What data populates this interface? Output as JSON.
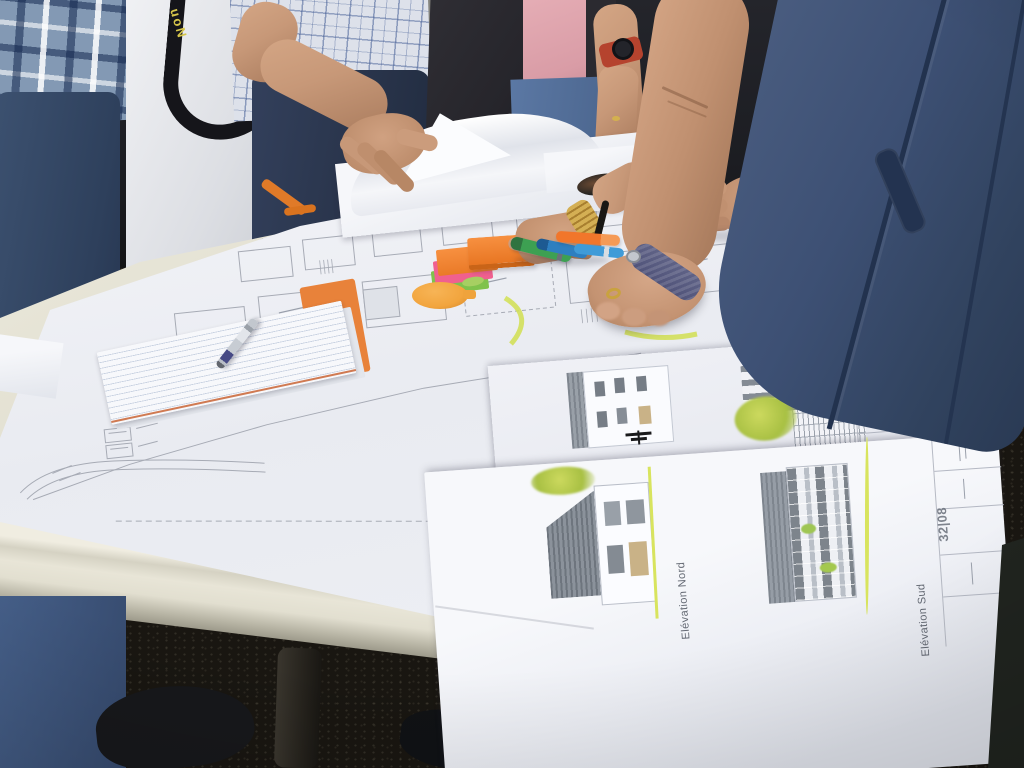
{
  "scene": {
    "setting": "Outdoor meeting: group of people standing around a white folding table reviewing large architectural plans",
    "ground": "dark gravel"
  },
  "people": [
    {
      "id": "person-plaid-shirt",
      "visible": "blue plaid shirt, dark jeans"
    },
    {
      "id": "person-white-shirt",
      "visible": "white t-shirt, black camera strap, belt, blue jeans"
    },
    {
      "id": "person-checked-shirt",
      "visible": "blue checked shirt, bare arm lifting a plan sheet"
    },
    {
      "id": "person-pink-shirt",
      "visible": "pink t-shirt, dark open jacket, jeans, wristwatch with red band"
    },
    {
      "id": "person-denim-leaning",
      "visible": "dark denim shirt leaning over table, purple fitness band, gold bracelet, gold ring"
    },
    {
      "id": "person-partial",
      "visible": "hand resting flat on the plans"
    }
  ],
  "table": {
    "type": "white folding table",
    "leg": "dark metal",
    "edge": "molded cream plastic"
  },
  "documents": {
    "site_plan": {
      "content": "faint floor-plan linework with small room rectangles and curved road lines",
      "highlights": "yellow-green highlighter arcs"
    },
    "elevation_sheets": {
      "labels": {
        "nord": "Elévation Nord",
        "sud": "Elévation Sud"
      },
      "sheet_number": "32|08",
      "drawing_accents": "yellow-green ground lines, small trees"
    },
    "notepad": {
      "type": "lined notepad",
      "cover": "orange"
    },
    "loose_sheets": "folded and curled plan sheets at top of table"
  },
  "objects": {
    "camera_strap_text": "uoN",
    "markers": [
      {
        "name": "green-marker",
        "hex": "#3da052"
      },
      {
        "name": "pink-marker",
        "hex": "#ee4f8a"
      },
      {
        "name": "orange-marker",
        "hex": "#f1762b"
      },
      {
        "name": "blue-marker-dark",
        "hex": "#2d7fc0"
      },
      {
        "name": "blue-marker-light",
        "hex": "#3f9bd8"
      }
    ],
    "sticky_notes": [
      {
        "name": "orange-pad",
        "hex": "#f28433"
      },
      {
        "name": "pink-pad",
        "hex": "#f0608f"
      },
      {
        "name": "green-pad",
        "hex": "#7fc24c"
      },
      {
        "name": "orange-paddle",
        "hex": "#f2a53e"
      }
    ],
    "pen": {
      "body": "silver",
      "grip": "blue"
    },
    "sunglasses": "dark folded sunglasses lying on sheet",
    "fitness_band_hex": "#5f6286",
    "watch_band_hex": "#b5432e"
  },
  "palette": {
    "table": "#e4e1d3",
    "paper": "#f3f4f8",
    "plan_line": "#a7abb5",
    "highlight": "#d6e35c",
    "denim": "#3f536e",
    "ground": "#191611",
    "skin": "#c9997b"
  }
}
